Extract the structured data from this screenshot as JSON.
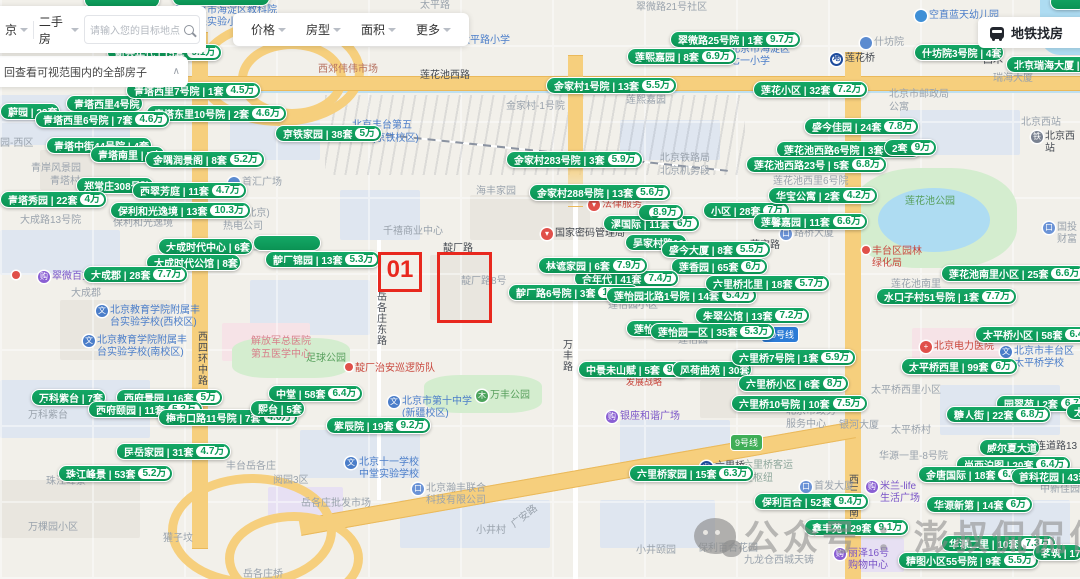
{
  "toolbar": {
    "city": "京",
    "channel": "二手房",
    "search_placeholder": "请输入您的目标地点",
    "filters": [
      "价格",
      "房型",
      "面积",
      "更多"
    ],
    "subway_label": "地铁找房"
  },
  "notice": {
    "text": "回查看可视范围内的全部房子"
  },
  "annotation": {
    "label": "01"
  },
  "watermark": {
    "text": "公众号 ：澎叔侃侃侃"
  },
  "colors": {
    "bubble_green": "#0b9354",
    "price_text": "#0b9a58",
    "annotation_red": "#e8281e",
    "highway_yellow": "#f6cf7d"
  },
  "badges": [
    {
      "x": 762,
      "y": 327,
      "text": "10号线",
      "bg": "#2b7bd6"
    },
    {
      "x": 731,
      "y": 435,
      "text": "9号线",
      "bg": "#3fae57"
    }
  ],
  "bubbles": [
    {
      "x": 0,
      "y": 103,
      "n": "蔚园",
      "c": "22套"
    },
    {
      "x": 66,
      "y": 95,
      "n": "青塔西里4号院"
    },
    {
      "x": 126,
      "y": 82,
      "n": "青塔西里7号院",
      "c": "1套",
      "p": "4.5万"
    },
    {
      "x": 146,
      "y": 105,
      "n": "青塔东里10号院",
      "c": "2套",
      "p": "4.6万"
    },
    {
      "x": 35,
      "y": 111,
      "n": "青塔西里6号院",
      "c": "7套",
      "p": "4.6万"
    },
    {
      "x": 275,
      "y": 125,
      "n": "京铁家园",
      "c": "38套",
      "p": "5万"
    },
    {
      "x": 46,
      "y": 137,
      "n": "青塔中街44号院",
      "c": "4套"
    },
    {
      "x": 90,
      "y": 146,
      "n": "青塔南里",
      "c": "5套"
    },
    {
      "x": 145,
      "y": 151,
      "n": "金隅润景阁",
      "c": "8套",
      "p": "5.2万"
    },
    {
      "x": 76,
      "y": 177,
      "n": "郑常庄308号院"
    },
    {
      "x": 132,
      "y": 182,
      "n": "西翠芳庭",
      "c": "11套",
      "p": "4.7万"
    },
    {
      "x": 0,
      "y": 191,
      "n": "青塔秀园",
      "c": "22套",
      "p": "4万"
    },
    {
      "x": 110,
      "y": 202,
      "n": "保利和光逸境",
      "c": "13套",
      "p": "10.3万"
    },
    {
      "x": 158,
      "y": 238,
      "n": "大成时代中心",
      "c": "6套"
    },
    {
      "x": 146,
      "y": 254,
      "n": "大成时代公馆",
      "c": "8套"
    },
    {
      "x": 265,
      "y": 251,
      "n": "靛厂锦园",
      "c": "13套",
      "p": "5.3万"
    },
    {
      "x": 83,
      "y": 266,
      "n": "大成郡",
      "c": "28套",
      "p": "7.7万"
    },
    {
      "x": 107,
      "y": 44,
      "n": "新兴年代",
      "c": "15套",
      "p": "9.1万"
    },
    {
      "x": 670,
      "y": 31,
      "n": "翠微路25号院",
      "c": "1套",
      "p": "9.7万"
    },
    {
      "x": 627,
      "y": 48,
      "n": "莲熙嘉园",
      "c": "8套",
      "p": "6.9万"
    },
    {
      "x": 914,
      "y": 44,
      "n": "什坊院3号院",
      "c": "4套"
    },
    {
      "x": 1006,
      "y": 56,
      "n": "北京瑞海大厦",
      "c": "1套"
    },
    {
      "x": 546,
      "y": 77,
      "n": "金家村1号院",
      "c": "13套",
      "p": "5.5万"
    },
    {
      "x": 753,
      "y": 81,
      "n": "莲花小区",
      "c": "32套",
      "p": "7.2万"
    },
    {
      "x": 804,
      "y": 118,
      "n": "盛今佳园",
      "c": "24套",
      "p": "7.8万"
    },
    {
      "x": 776,
      "y": 141,
      "n": "莲花池西路6号院",
      "c": "3套",
      "p": "6.8万"
    },
    {
      "x": 884,
      "y": 139,
      "c": "2套",
      "p": "9万"
    },
    {
      "x": 746,
      "y": 156,
      "n": "莲花池西路23号",
      "c": "5套",
      "p": "6.8万"
    },
    {
      "x": 506,
      "y": 151,
      "n": "金家村283号院",
      "c": "3套",
      "p": "5.9万"
    },
    {
      "x": 529,
      "y": 184,
      "n": "金家村288号院",
      "c": "13套",
      "p": "5.6万"
    },
    {
      "x": 603,
      "y": 215,
      "n": "漯国际",
      "c": "11套",
      "p": "6万"
    },
    {
      "x": 638,
      "y": 204,
      "p": "8.9万",
      "minw": 26
    },
    {
      "x": 703,
      "y": 202,
      "n": "小区",
      "c": "28套",
      "p": "7万"
    },
    {
      "x": 768,
      "y": 187,
      "n": "华宝公寓",
      "c": "2套",
      "p": "4.2万"
    },
    {
      "x": 753,
      "y": 213,
      "n": "莲馨嘉园",
      "c": "11套",
      "p": "6.6万"
    },
    {
      "x": 625,
      "y": 234,
      "n": "吴家村路10"
    },
    {
      "x": 661,
      "y": 241,
      "n": "盛今大厦",
      "c": "8套",
      "p": "5.5万"
    },
    {
      "x": 671,
      "y": 258,
      "n": "莲香园",
      "c": "65套",
      "p": "6万"
    },
    {
      "x": 574,
      "y": 270,
      "n": "合年代",
      "c": "41套",
      "p": "7.4万"
    },
    {
      "x": 538,
      "y": 257,
      "n": "林遮家园",
      "c": "6套",
      "p": "7.9万"
    },
    {
      "x": 508,
      "y": 284,
      "n": "靛厂路6号院",
      "c": "3套",
      "p": "10.3万"
    },
    {
      "x": 606,
      "y": 287,
      "n": "莲怡园北路1号院",
      "c": "14套",
      "p": "5.4万"
    },
    {
      "x": 705,
      "y": 275,
      "n": "六里桥北里",
      "c": "18套",
      "p": "5.7万"
    },
    {
      "x": 695,
      "y": 307,
      "n": "朱翠公馆",
      "c": "13套",
      "p": "7.2万"
    },
    {
      "x": 626,
      "y": 320,
      "n": "莲怡园二区"
    },
    {
      "x": 650,
      "y": 323,
      "n": "莲怡园一区",
      "c": "35套",
      "p": "5.3万"
    },
    {
      "x": 941,
      "y": 265,
      "n": "莲花池南里小区",
      "c": "25套",
      "p": "6.6万"
    },
    {
      "x": 876,
      "y": 288,
      "n": "水口子村51号院",
      "c": "1套",
      "p": "7.7万"
    },
    {
      "x": 975,
      "y": 326,
      "n": "太平桥小区",
      "c": "58套",
      "p": "6.4万"
    },
    {
      "x": 901,
      "y": 358,
      "n": "太平桥西里",
      "c": "99套",
      "p": "6万"
    },
    {
      "x": 996,
      "y": 395,
      "n": "园翠苑",
      "c": "2套",
      "p": "6.7万"
    },
    {
      "x": 1066,
      "y": 403,
      "n": "太",
      "minw": 26
    },
    {
      "x": 946,
      "y": 406,
      "n": "糖人街",
      "c": "22套",
      "p": "6.8万"
    },
    {
      "x": 578,
      "y": 361,
      "n": "中景未山赋",
      "c": "5套",
      "p": "9万"
    },
    {
      "x": 672,
      "y": 361,
      "n": "风荷曲苑",
      "c": "30套"
    },
    {
      "x": 731,
      "y": 349,
      "n": "六里桥7号院",
      "c": "1套",
      "p": "5.9万"
    },
    {
      "x": 738,
      "y": 375,
      "n": "六里桥小区",
      "c": "6套",
      "p": "8万"
    },
    {
      "x": 731,
      "y": 395,
      "n": "六里桥10号院",
      "c": "10套",
      "p": "7.5万"
    },
    {
      "x": 31,
      "y": 389,
      "n": "万科紫台",
      "c": "7套"
    },
    {
      "x": 116,
      "y": 389,
      "n": "西府景园",
      "c": "16套",
      "p": "5万"
    },
    {
      "x": 88,
      "y": 401,
      "n": "西府颐园",
      "c": "11套",
      "p": "5.2万"
    },
    {
      "x": 158,
      "y": 409,
      "n": "梅市口路11号院",
      "c": "7套",
      "p": "4.6万"
    },
    {
      "x": 250,
      "y": 400,
      "n": "熙台",
      "c": "5套"
    },
    {
      "x": 268,
      "y": 385,
      "n": "中堂",
      "c": "58套",
      "p": "6.4万"
    },
    {
      "x": 326,
      "y": 417,
      "n": "紫辰院",
      "c": "19套",
      "p": "9.2万"
    },
    {
      "x": 116,
      "y": 443,
      "n": "民岳家园",
      "c": "31套",
      "p": "4.7万"
    },
    {
      "x": 58,
      "y": 465,
      "n": "珠江峰景",
      "c": "53套",
      "p": "5.2万"
    },
    {
      "x": 629,
      "y": 465,
      "n": "六里桥家园",
      "c": "15套",
      "p": "6.3万"
    },
    {
      "x": 754,
      "y": 493,
      "n": "保利百合",
      "c": "52套",
      "p": "9.4万"
    },
    {
      "x": 804,
      "y": 519,
      "n": "鑫丰苑",
      "c": "29套",
      "p": "9.1万"
    },
    {
      "x": 979,
      "y": 439,
      "n": "威尔夏大道"
    },
    {
      "x": 956,
      "y": 456,
      "n": "尚西泊图",
      "c": "20套",
      "p": "6.4万"
    },
    {
      "x": 918,
      "y": 466,
      "n": "金唐国际",
      "c": "18套",
      "p": "6.6万"
    },
    {
      "x": 1011,
      "y": 468,
      "n": "首科花园",
      "c": "43套",
      "p": "7万"
    },
    {
      "x": 926,
      "y": 496,
      "n": "华源新第",
      "c": "14套",
      "p": "6万"
    },
    {
      "x": 941,
      "y": 535,
      "n": "华源二里",
      "c": "10套",
      "p": "7.3万"
    },
    {
      "x": 898,
      "y": 552,
      "n": "精图小区55号院",
      "c": "9套",
      "p": "5.5万"
    },
    {
      "x": 1033,
      "y": 544,
      "n": "茗筑",
      "c": "17"
    }
  ],
  "map_labels": [
    {
      "x": 636,
      "y": 2,
      "text": "翠微路21号社区"
    },
    {
      "x": 96,
      "y": 2,
      "text": "太平园"
    },
    {
      "x": 420,
      "y": 0,
      "text": "太平路"
    },
    {
      "x": 318,
      "y": 64,
      "text": "西郊伟伟市场",
      "color": "#b5705f"
    },
    {
      "x": 420,
      "y": 70,
      "text": "莲花池西路",
      "color": "#454a52"
    },
    {
      "x": 506,
      "y": 101,
      "text": "金家村-1号院"
    },
    {
      "x": 626,
      "y": 95,
      "text": "莲熙嘉园"
    },
    {
      "x": 352,
      "y": 120,
      "text": "北京丰台第五\n小学(京铁校区)",
      "color": "#4a7dc9"
    },
    {
      "x": 660,
      "y": 153,
      "text": "北京铁路局\n北京机务段"
    },
    {
      "x": 476,
      "y": 186,
      "text": "海丰家园"
    },
    {
      "x": 50,
      "y": 176,
      "text": "青塔村"
    },
    {
      "x": 31,
      "y": 163,
      "text": "青岸风景园"
    },
    {
      "x": 0,
      "y": 138,
      "text": "园-西区"
    },
    {
      "x": 20,
      "y": 215,
      "text": "大成路13号院"
    },
    {
      "x": 113,
      "y": 218,
      "text": "保利和光逸境"
    },
    {
      "x": 223,
      "y": 208,
      "text": "华电(北京)\n热电公司"
    },
    {
      "x": 71,
      "y": 288,
      "text": "大成郡"
    },
    {
      "x": 233,
      "y": 242,
      "text": "西府兰庭"
    },
    {
      "x": 383,
      "y": 226,
      "text": "千禧商业中心"
    },
    {
      "x": 993,
      "y": 73,
      "text": "瑞海大厦"
    },
    {
      "x": 889,
      "y": 89,
      "text": "北京市邮政局\n公寓"
    },
    {
      "x": 1021,
      "y": 117,
      "text": "北京西站"
    },
    {
      "x": 983,
      "y": 55,
      "text": "西木",
      "color": "#454a52"
    },
    {
      "x": 905,
      "y": 196,
      "text": "莲花池公园",
      "color": "#58a05d"
    },
    {
      "x": 891,
      "y": 279,
      "text": "莲花池南里"
    },
    {
      "x": 773,
      "y": 176,
      "text": "莲花池西里6号院"
    },
    {
      "x": 750,
      "y": 240,
      "text": "莲宝路",
      "color": "#454a52"
    },
    {
      "x": 608,
      "y": 300,
      "text": "莲怡园小区"
    },
    {
      "x": 678,
      "y": 335,
      "text": "莲怡园"
    },
    {
      "x": 461,
      "y": 276,
      "text": "靛厂路8号"
    },
    {
      "x": 443,
      "y": 243,
      "text": "靛厂路",
      "color": "#454a52"
    },
    {
      "x": 373,
      "y": 291,
      "text": "岳各庄东路",
      "vertical": true,
      "color": "#454a52"
    },
    {
      "x": 194,
      "y": 331,
      "text": "西四环中路",
      "vertical": true,
      "color": "#454a52"
    },
    {
      "x": 559,
      "y": 339,
      "text": "万丰路",
      "vertical": true,
      "color": "#454a52"
    },
    {
      "x": 845,
      "y": 474,
      "text": "西三环南路",
      "vertical": true,
      "color": "#454a52"
    },
    {
      "x": 306,
      "y": 353,
      "text": "足球公园",
      "color": "#58a05d"
    },
    {
      "x": 28,
      "y": 410,
      "text": "万科紫台"
    },
    {
      "x": 46,
      "y": 476,
      "text": "珠江峰景"
    },
    {
      "x": 226,
      "y": 461,
      "text": "丰台岳各庄"
    },
    {
      "x": 273,
      "y": 475,
      "text": "阅园3区"
    },
    {
      "x": 301,
      "y": 498,
      "text": "岳各庄批发市场"
    },
    {
      "x": 476,
      "y": 525,
      "text": "小井村"
    },
    {
      "x": 510,
      "y": 511,
      "text": "广安路",
      "rotate": -38
    },
    {
      "x": 243,
      "y": 569,
      "text": "岳各庄桥"
    },
    {
      "x": 28,
      "y": 522,
      "text": "万棵园小区"
    },
    {
      "x": 163,
      "y": 533,
      "text": "獾子坟"
    },
    {
      "x": 636,
      "y": 545,
      "text": "小井颐园"
    },
    {
      "x": 698,
      "y": 543,
      "text": "保利百合花园"
    },
    {
      "x": 744,
      "y": 555,
      "text": "九龙仓西城天铸"
    },
    {
      "x": 743,
      "y": 460,
      "text": "六里桥客运\n主枢纽",
      "color": "#8fa89d"
    },
    {
      "x": 879,
      "y": 451,
      "text": "华源一里-8号院"
    },
    {
      "x": 891,
      "y": 425,
      "text": "太平桥村"
    },
    {
      "x": 839,
      "y": 420,
      "text": "银河大厦"
    },
    {
      "x": 786,
      "y": 406,
      "text": "北京市政务\n服务中心"
    },
    {
      "x": 871,
      "y": 385,
      "text": "太平桥西里小区"
    },
    {
      "x": 1026,
      "y": 441,
      "text": "马连道路13",
      "color": "#454a52"
    },
    {
      "x": 1040,
      "y": 484,
      "text": "中新佳园"
    },
    {
      "x": 626,
      "y": 377,
      "text": "发展战略",
      "color": "#c9473d",
      "size": 9
    },
    {
      "x": 251,
      "y": 336,
      "text": "解放军总医院\n第五医学中心",
      "color": "#d77f8a"
    }
  ],
  "pois": [
    {
      "x": 38,
      "y": 271,
      "icon": "mall",
      "text": "翠微百货",
      "tc": "#7a55c8"
    },
    {
      "x": 12,
      "y": 271,
      "icon": "dot",
      "text": ""
    },
    {
      "x": 96,
      "y": 305,
      "icon": "school",
      "text": "北京教育学院附属丰\n台实验学校(西校区)",
      "tc": "#4a7dc9"
    },
    {
      "x": 83,
      "y": 335,
      "icon": "school",
      "text": "北京教育学院附属丰\n台实验学校(南校区)",
      "tc": "#4a7dc9"
    },
    {
      "x": 228,
      "y": 177,
      "icon": "circle",
      "text": "首汇广场",
      "tc": "#9aa3ad"
    },
    {
      "x": 541,
      "y": 228,
      "icon": "pin",
      "text": "国家密码管理局",
      "tc": "#454a52"
    },
    {
      "x": 588,
      "y": 199,
      "icon": "pin",
      "text": "法律服务",
      "tc": "#c9473d"
    },
    {
      "x": 345,
      "y": 363,
      "icon": "dot",
      "text": "靛厂治安巡逻防队",
      "tc": "#c9473d"
    },
    {
      "x": 345,
      "y": 457,
      "icon": "school",
      "text": "北京十一学校\n中堂实验学校",
      "tc": "#4a7dc9"
    },
    {
      "x": 388,
      "y": 396,
      "icon": "school",
      "text": "北京市第十中学\n(新疆校区)",
      "tc": "#4a7dc9"
    },
    {
      "x": 412,
      "y": 483,
      "icon": "building",
      "text": "北京瀚丰联合\n科技有限公司",
      "tc": "#9aa3ad"
    },
    {
      "x": 780,
      "y": 228,
      "icon": "building",
      "text": "路桥大厦",
      "tc": "#9aa3ad"
    },
    {
      "x": 862,
      "y": 246,
      "icon": "dot",
      "text": "丰台区园林\n绿化局",
      "tc": "#c9473d"
    },
    {
      "x": 915,
      "y": 10,
      "icon": "drop",
      "text": "空直蓝天幼儿园",
      "tc": "#4a7dc9"
    },
    {
      "x": 860,
      "y": 37,
      "icon": "circle",
      "text": "什坊院",
      "tc": "#9aa3ad"
    },
    {
      "x": 716,
      "y": 44,
      "icon": "school",
      "text": "北京市海淀区\n七一小学",
      "tc": "#4a7dc9"
    },
    {
      "x": 460,
      "y": 35,
      "icon": "none",
      "text": "太平路小学",
      "tc": "#4a7dc9"
    },
    {
      "x": 173,
      "y": 5,
      "icon": "school",
      "text": "北京市海淀区教科院\n未来实验小学",
      "tc": "#4a7dc9"
    },
    {
      "x": 830,
      "y": 53,
      "icon": "subway",
      "text": "莲花桥",
      "tc": "#454a52"
    },
    {
      "x": 700,
      "y": 461,
      "icon": "subway",
      "text": "六里桥",
      "tc": "#454a52"
    },
    {
      "x": 1031,
      "y": 131,
      "icon": "rail",
      "text": "北京西站",
      "tc": "#454a52"
    },
    {
      "x": 866,
      "y": 481,
      "icon": "mall",
      "text": "米兰-life\n生活广场",
      "tc": "#7a55c8"
    },
    {
      "x": 834,
      "y": 548,
      "icon": "mall",
      "text": "丽泽16号\n购物中心",
      "tc": "#7a55c8"
    },
    {
      "x": 606,
      "y": 411,
      "icon": "mall",
      "text": "银座和谐广场",
      "tc": "#7a55c8"
    },
    {
      "x": 1043,
      "y": 222,
      "icon": "building",
      "text": "国投财富",
      "tc": "#9aa3ad"
    },
    {
      "x": 920,
      "y": 341,
      "icon": "hospital",
      "text": "北京电力医院",
      "tc": "#c9473d"
    },
    {
      "x": 1000,
      "y": 346,
      "icon": "school",
      "text": "北京市丰台区\n太平桥学校",
      "tc": "#4a7dc9"
    },
    {
      "x": 664,
      "y": 366,
      "icon": "dot",
      "text": ""
    },
    {
      "x": 800,
      "y": 481,
      "icon": "building",
      "text": "首发大厦",
      "tc": "#9aa3ad"
    },
    {
      "x": 476,
      "y": 390,
      "icon": "park",
      "text": "万丰公园",
      "tc": "#58a05d"
    }
  ]
}
